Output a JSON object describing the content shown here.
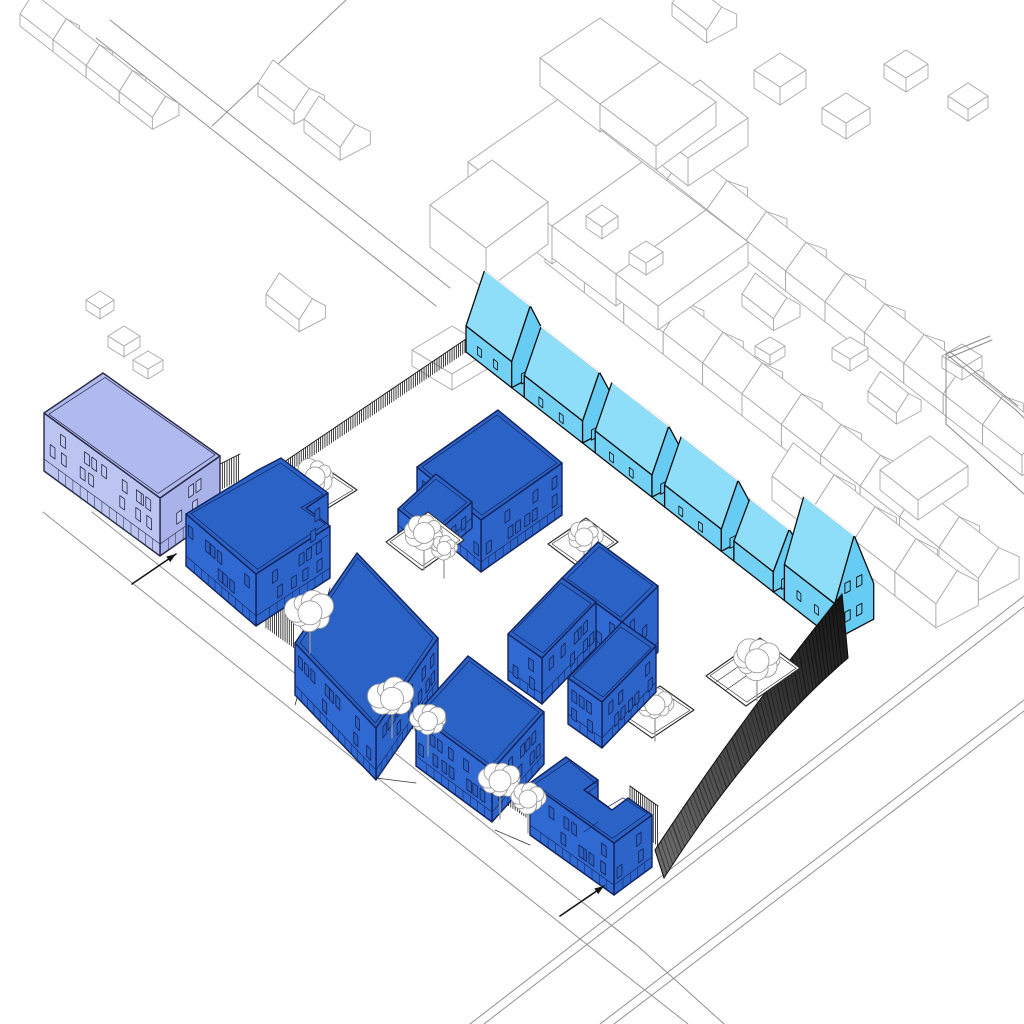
{
  "diagram": {
    "title": "Axonometric architectural site massing diagram",
    "type": "architectural-axonometric",
    "background": "#ffffff",
    "visible_text": []
  },
  "colors": {
    "ground": "#ffffff",
    "proposed_wall": "#3069d1",
    "proposed_wall_side": "#2d64c9",
    "proposed_roof": "#2b62c6",
    "proposed_outline": "#13245c",
    "proposed_window": "#2b5fc0",
    "mews_wall": "#72d1f5",
    "mews_roof": "#8edef9",
    "mews_gable": "#66ccf4",
    "mews_outline": "#0d0d0d",
    "existing_wall": "#bcc5f1",
    "existing_wall_side": "#a9b3e9",
    "existing_roof": "#b0baee",
    "existing_outline": "#2a2a46",
    "context_line": "#a9a9a9",
    "context_fill": "#ffffff",
    "road_line": "#909090",
    "fence_dark": "#141414",
    "boundary_wall_dark_start": "#151515",
    "boundary_wall_dark_end": "#6e6e6e",
    "tree_line": "#9a9a9a",
    "planter_line": "#2a2a2a",
    "arrow": "#141414"
  },
  "site": {
    "proposed_buildings": [
      {
        "id": "building-a",
        "shape": "L-shaped corner block",
        "storeys": 3
      },
      {
        "id": "building-b",
        "shape": "square courtyard block",
        "storeys": 3
      },
      {
        "id": "building-c",
        "shape": "large block with angled wing and roof planter",
        "storeys": 3
      },
      {
        "id": "building-d",
        "shape": "stepped U-shaped block with courtyard",
        "storeys": 4
      },
      {
        "id": "building-e",
        "shape": "square street block",
        "storeys": 3
      },
      {
        "id": "building-f",
        "shape": "L-shaped south block",
        "storeys": 3
      }
    ],
    "mews_houses": {
      "count": 6,
      "links_between": 5,
      "description": "gabled terraced houses with low links along north-east boundary"
    },
    "existing_building": {
      "id": "existing-building",
      "shape": "long rectangular block outside site to the west",
      "storeys": 2
    },
    "entrance_arrows": {
      "count": 2,
      "positions": [
        "west street entrance",
        "south street entrance"
      ]
    },
    "planters_with_trees": 6,
    "street_trees": 5,
    "boundary": {
      "north_west": "hatched fence",
      "north_east": "mews terrace row",
      "south_east": "dark tapering brick wall",
      "south_west": "street frontage with gap fences and trees"
    }
  }
}
